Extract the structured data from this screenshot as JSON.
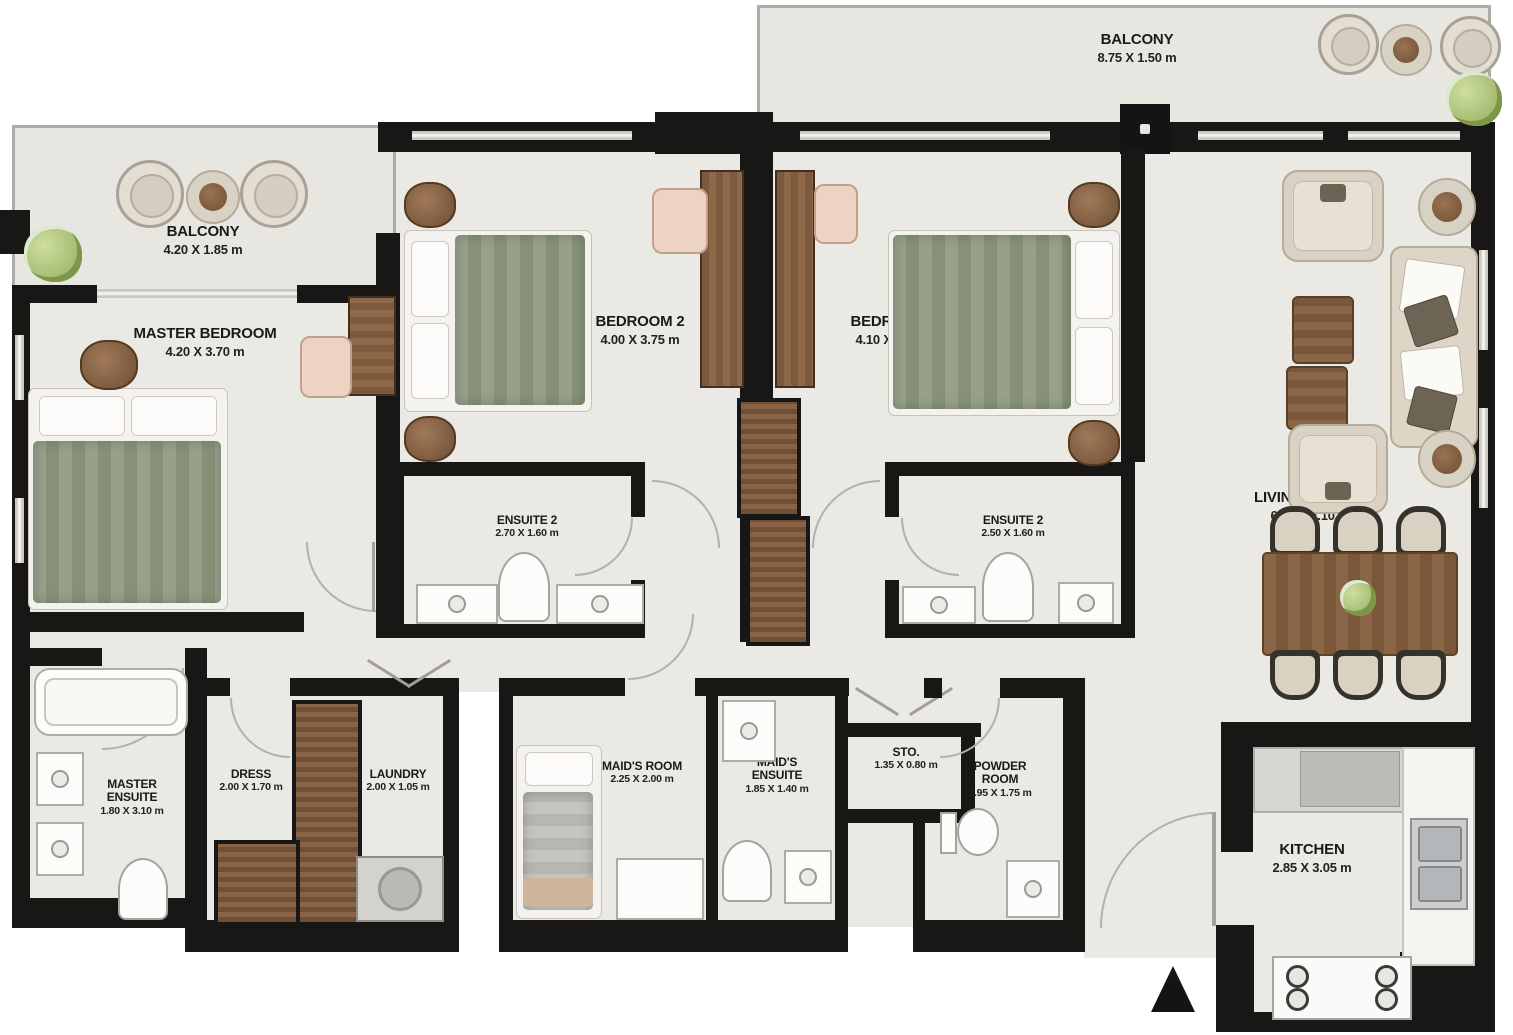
{
  "rooms": [
    {
      "id": "balcony-top",
      "name": "BALCONY",
      "dims": "8.75 X 1.50 m"
    },
    {
      "id": "balcony-left",
      "name": "BALCONY",
      "dims": "4.20 X 1.85 m"
    },
    {
      "id": "master-bedroom",
      "name": "MASTER BEDROOM",
      "dims": "4.20 X 3.70 m"
    },
    {
      "id": "bedroom-2",
      "name": "BEDROOM 2",
      "dims": "4.00 X 3.75 m"
    },
    {
      "id": "bedroom-3",
      "name": "BEDROOM 3",
      "dims": "4.10 X 3.75 m"
    },
    {
      "id": "living-dining",
      "name": "LIVING / DINING",
      "dims": "6.75 X 4.10 m"
    },
    {
      "id": "ensuite-2-a",
      "name": "ENSUITE 2",
      "dims": "2.70 X 1.60 m"
    },
    {
      "id": "ensuite-2-b",
      "name": "ENSUITE 2",
      "dims": "2.50 X 1.60 m"
    },
    {
      "id": "master-ensuite",
      "name": "MASTER ENSUITE",
      "dims": "1.80 X 3.10 m"
    },
    {
      "id": "dress",
      "name": "DRESS",
      "dims": "2.00 X 1.70 m"
    },
    {
      "id": "laundry",
      "name": "LAUNDRY",
      "dims": "2.00 X 1.05 m"
    },
    {
      "id": "maids-room",
      "name": "MAID'S ROOM",
      "dims": "2.25 X 2.00 m"
    },
    {
      "id": "maids-ensuite",
      "name": "MAID'S ENSUITE",
      "dims": "1.85 X 1.40 m"
    },
    {
      "id": "storage",
      "name": "STO.",
      "dims": "1.35 X 0.80 m"
    },
    {
      "id": "powder-room",
      "name": "POWDER ROOM",
      "dims": "1.95 X 1.75 m"
    },
    {
      "id": "kitchen",
      "name": "KITCHEN",
      "dims": "2.85 X 3.05 m"
    }
  ],
  "colors": {
    "wall": "#181715",
    "floor": "#ebe9e3",
    "balcony_floor": "#e8e6e0",
    "wood": "#8a6647",
    "bedding_green": "#97a08b",
    "plant_green": "#9cb468",
    "fixture_outline": "#adaba5"
  }
}
